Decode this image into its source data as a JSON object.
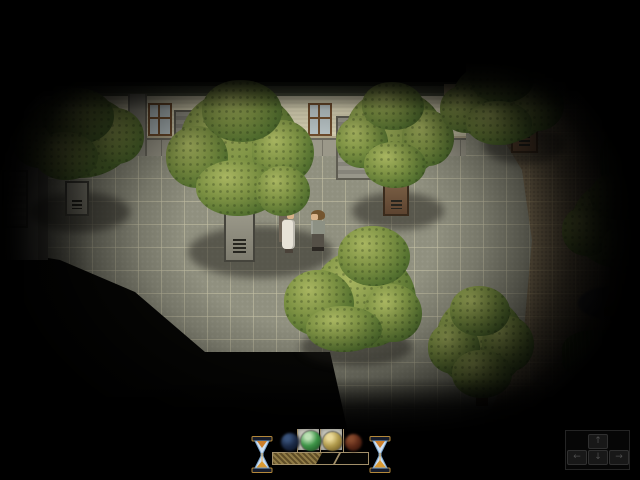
{
  "meta": {
    "app": "rpg-game-scene",
    "scene_description": "night courtyard with trees, two characters and memory HUD"
  },
  "colors": {
    "leaf_hi": "#a9b661",
    "leaf_mid": "#7c9143",
    "leaf_dark": "#53702f",
    "leaf_edge": "#33491f",
    "stone_face": "#9a9889",
    "stone_face2": "#7e7c6f",
    "stone_border": "#45443c",
    "brown_face": "#7a5f45",
    "brown_face2": "#5d4430",
    "brown_border": "#3a2b1c",
    "shadow": "rgba(32,30,26,0.5)",
    "gravel": "#53545b",
    "gravel_edge": "#3e3f46",
    "grass_hi": "#7ea24a",
    "grass_dark": "#4c6b26",
    "trunk": "#7a5c3a",
    "trunk_dark": "#4e3a22"
  },
  "scene": {
    "shadows": [
      {
        "x": 30,
        "y": 192,
        "w": 100,
        "h": 40
      },
      {
        "x": 188,
        "y": 226,
        "w": 145,
        "h": 52
      },
      {
        "x": 352,
        "y": 192,
        "w": 92,
        "h": 38
      },
      {
        "x": 483,
        "y": 126,
        "w": 82,
        "h": 38
      },
      {
        "x": 300,
        "y": 328,
        "w": 112,
        "h": 38
      }
    ],
    "planters": [
      {
        "x": 65,
        "y": 181,
        "w": 24,
        "h": 35,
        "kind": "stone"
      },
      {
        "x": 224,
        "y": 212,
        "w": 31,
        "h": 50,
        "kind": "stone"
      },
      {
        "x": 383,
        "y": 181,
        "w": 26,
        "h": 35,
        "kind": "brown"
      },
      {
        "x": 511,
        "y": 116,
        "w": 27,
        "h": 37,
        "kind": "brown"
      }
    ],
    "gravel_patch": {
      "x": 578,
      "y": 286,
      "w": 72,
      "h": 34
    },
    "big_trunk": {
      "x": 604,
      "y": 266,
      "w": 24,
      "h": 50
    },
    "small_trunk": {
      "x": 476,
      "y": 396,
      "w": 12,
      "h": 10
    },
    "grass_clumps": [
      {
        "x": 600,
        "y": 134,
        "w": 40,
        "h": 52
      },
      {
        "x": 562,
        "y": 330,
        "w": 80,
        "h": 48
      },
      {
        "x": 598,
        "y": 366,
        "w": 44,
        "h": 58
      }
    ],
    "trees": [
      {
        "name": "tree-top-left",
        "box": [
          12,
          88,
          132,
          96
        ],
        "blobs": [
          [
            10,
            6,
            112,
            84
          ],
          [
            0,
            28,
            56,
            52
          ],
          [
            76,
            20,
            56,
            56
          ],
          [
            30,
            0,
            72,
            56
          ],
          [
            22,
            44,
            64,
            48
          ]
        ]
      },
      {
        "name": "tree-center",
        "box": [
          166,
          80,
          148,
          140
        ],
        "blobs": [
          [
            14,
            10,
            120,
            110
          ],
          [
            0,
            46,
            62,
            62
          ],
          [
            86,
            40,
            62,
            64
          ],
          [
            36,
            0,
            80,
            62
          ],
          [
            30,
            80,
            84,
            56
          ],
          [
            90,
            86,
            54,
            50
          ]
        ]
      },
      {
        "name": "tree-mid-right",
        "box": [
          336,
          82,
          118,
          108
        ],
        "blobs": [
          [
            10,
            8,
            98,
            88
          ],
          [
            0,
            34,
            52,
            52
          ],
          [
            66,
            28,
            52,
            56
          ],
          [
            26,
            0,
            62,
            48
          ],
          [
            28,
            60,
            62,
            46
          ]
        ]
      },
      {
        "name": "tree-top-right",
        "box": [
          440,
          55,
          124,
          96
        ],
        "blobs": [
          [
            12,
            6,
            100,
            82
          ],
          [
            0,
            30,
            54,
            48
          ],
          [
            70,
            24,
            54,
            52
          ],
          [
            30,
            0,
            64,
            48
          ],
          [
            26,
            46,
            66,
            44
          ]
        ]
      },
      {
        "name": "tree-bottom-center",
        "box": [
          276,
          226,
          146,
          128
        ],
        "blobs": [
          [
            36,
            24,
            104,
            98
          ],
          [
            62,
            0,
            72,
            60
          ],
          [
            8,
            44,
            70,
            66
          ],
          [
            88,
            58,
            58,
            58
          ],
          [
            30,
            80,
            76,
            46
          ]
        ]
      },
      {
        "name": "tree-bottom-right",
        "box": [
          428,
          286,
          106,
          118
        ],
        "blobs": [
          [
            8,
            10,
            90,
            92
          ],
          [
            0,
            36,
            52,
            52
          ],
          [
            54,
            30,
            52,
            56
          ],
          [
            22,
            0,
            60,
            50
          ],
          [
            24,
            64,
            60,
            48
          ]
        ]
      },
      {
        "name": "tree-right-edge",
        "box": [
          562,
          172,
          100,
          104
        ],
        "blobs": [
          [
            10,
            8,
            96,
            88
          ],
          [
            0,
            34,
            50,
            50
          ],
          [
            28,
            0,
            60,
            48
          ],
          [
            40,
            50,
            60,
            52
          ]
        ]
      }
    ],
    "characters": [
      {
        "name": "character-woman",
        "x": 279,
        "y": 209,
        "facing": "right",
        "hair": "#6f6557",
        "skin": "#d8b28a",
        "outfit": "#e7e3d7",
        "shoes": "#4a4239"
      },
      {
        "name": "character-man",
        "x": 308,
        "y": 210,
        "facing": "left",
        "hair": "#74552f",
        "skin": "#dab48c",
        "outfit": "#8d9184",
        "pants": "#555047",
        "shoes": "#2c2823"
      }
    ]
  },
  "hud": {
    "slots": [
      {
        "x": 298,
        "y": 4
      },
      {
        "x": 321,
        "y": 4
      }
    ],
    "ticks": [
      297,
      320,
      343
    ],
    "orbs": [
      {
        "id": "orb-blue",
        "x": 281,
        "y": 8,
        "d": 18,
        "base": "#223457",
        "hi": "#48689a",
        "edge": "#0d1628",
        "active": false
      },
      {
        "id": "orb-green",
        "x": 301,
        "y": 6,
        "d": 20,
        "base": "#3d9447",
        "hi": "#bce0b4",
        "edge": "#1c4a20",
        "active": true
      },
      {
        "id": "orb-gold",
        "x": 323,
        "y": 7,
        "d": 19,
        "base": "#b09a4c",
        "hi": "#ead998",
        "edge": "#6a5420",
        "active": true
      },
      {
        "id": "orb-red",
        "x": 345,
        "y": 9,
        "d": 17,
        "base": "#74331d",
        "hi": "#a85c38",
        "edge": "#381408",
        "active": false
      }
    ],
    "bar": {
      "x": 272,
      "y": 27,
      "w": 95,
      "h": 11,
      "fill_px": 45,
      "separator_px": 64,
      "frame_color": "#a3906a",
      "fill_color": "#8f7a45",
      "fill_percent": 47
    },
    "keys": {
      "box": {
        "x": 565,
        "y": 5,
        "w": 63,
        "h": 38
      },
      "items": [
        {
          "glyph": "↑",
          "x": 588,
          "y": 9
        },
        {
          "glyph": "←",
          "x": 567,
          "y": 25
        },
        {
          "glyph": "↓",
          "x": 588,
          "y": 25
        },
        {
          "glyph": "→",
          "x": 609,
          "y": 25
        }
      ]
    }
  }
}
